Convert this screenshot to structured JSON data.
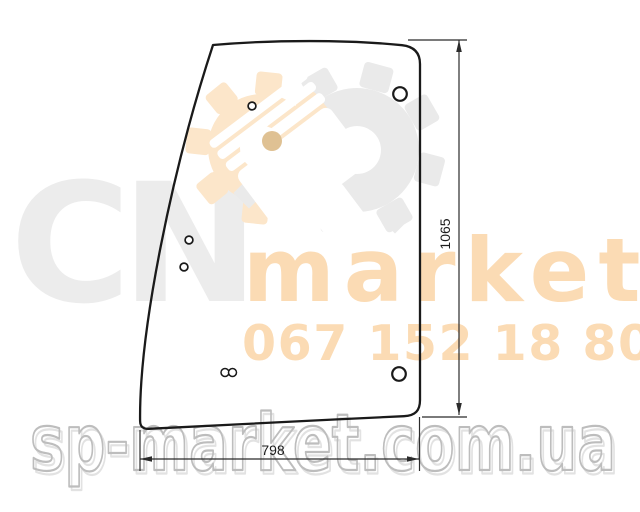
{
  "canvas": {
    "background": "#ffffff"
  },
  "drawing": {
    "height_dim": "1065",
    "width_dim": "798",
    "outline_color": "#1a1a1a",
    "dim_color": "#2b2b2b",
    "text_color": "#1b1b1b"
  },
  "watermarks": {
    "brand_letters": "CN",
    "brand_word": "market",
    "phone": "067 152 18 80",
    "site": "sp-market.com.ua",
    "orange": "#fbdbb4",
    "peach_gear": "#fce6ca",
    "gray_gear": "#eaeaea",
    "letter_gray": "#ececec",
    "pin_tan": "#dfc193",
    "site_outline": "#bdbdbd",
    "site_shadow": "#e2e2e2"
  }
}
